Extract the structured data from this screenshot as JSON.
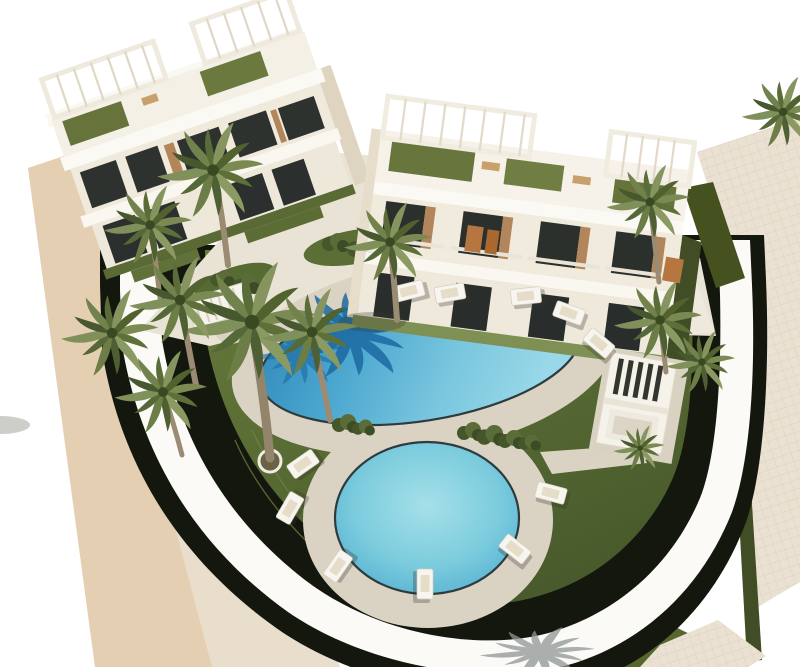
{
  "scene": {
    "type": "architectural-3d-render",
    "description": "Aerial rendering of a modern white apartment complex with two turquoise swimming pools, beige sun decks, sun loungers, lawns, palm trees and a curved white perimeter wall",
    "elements": [
      "left-apartment-building",
      "right-apartment-building",
      "large-pool",
      "small-pool",
      "pool-deck",
      "sun-loungers",
      "palm-trees",
      "lawn",
      "curved-perimeter-wall",
      "shadow-hedge-band",
      "side-walkway",
      "pergola-gazebo",
      "pool-railing",
      "garden-bushes"
    ]
  },
  "colors": {
    "background": "#ffffff",
    "strip_outer": "#e5cfb2",
    "strip_inner": "#e9decc",
    "pavement": "#eae1d2",
    "shadow_band": "#13170d",
    "wall_white": "#fbfaf6",
    "lawn": "#5d7134",
    "lawn_dark": "#46572a",
    "deck": "#dad3c4",
    "plaza": "#e9e3d5",
    "walkway": "#efe9dd",
    "pool_deep": "#2f85b8",
    "pool_light": "#98d8e8",
    "pool_small": "#7cccdd",
    "pool_rim": "#2e3b3c",
    "building_white": "#f7f4ed",
    "building_shade": "#eae3d3",
    "window_dark": "#2b2f2d",
    "wood_accent": "#b2855a",
    "palm_green": "#6d7c46",
    "palm_dark": "#4c5c31",
    "trunk": "#9a8b72",
    "lounger_white": "#f7f5f0",
    "hedge_light": "#8d9d5f",
    "hedge_dark": "#45511f"
  }
}
